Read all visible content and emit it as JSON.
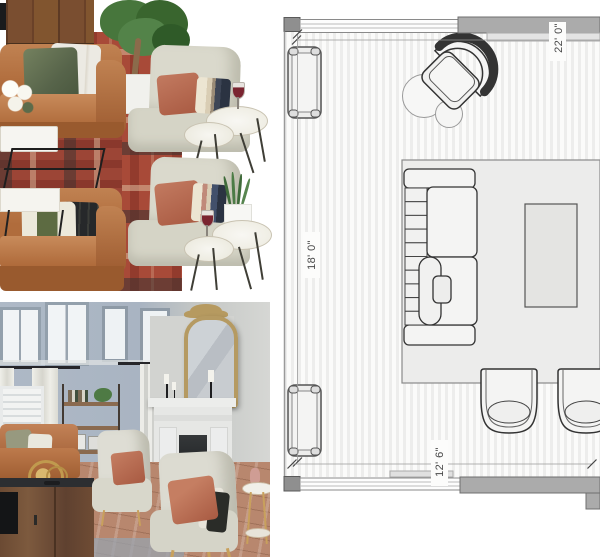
{
  "floor_plan": {
    "dimension_labels": {
      "top": "22' 0\"",
      "left": "18' 0\"",
      "bottom": "12' 6\""
    }
  },
  "palette": {
    "leather": "#b06f41",
    "rug_red": "#a84a38",
    "chair_fabric": "#d9d8cc",
    "rust_pillow": "#b4654e",
    "sage_pillow": "#62704f",
    "wall_blue": "#a9b4c2",
    "mirror_gold": "#b49a62",
    "plan_wall_gray": "#a9a9a9",
    "plan_floor_stripe": "#ededec",
    "plan_line": "#3c3c3c"
  }
}
